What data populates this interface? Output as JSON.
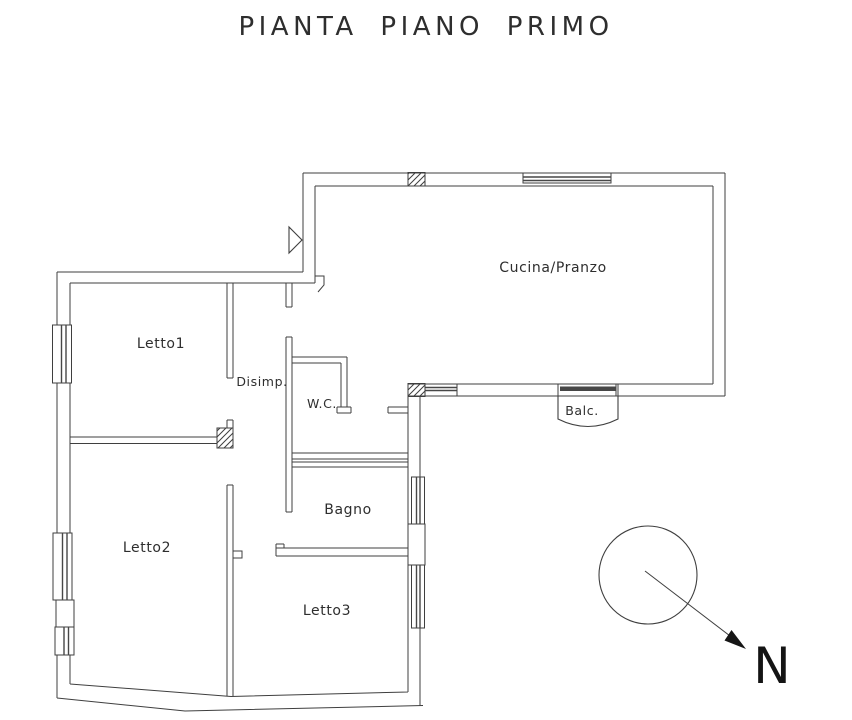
{
  "title": "PIANTA PIANO PRIMO",
  "labels": {
    "cucina": "Cucina/Pranzo",
    "letto1": "Letto1",
    "disimp": "Disimp.",
    "wc": "W.C.",
    "bagno": "Bagno",
    "letto2": "Letto2",
    "letto3": "Letto3",
    "balc": "Balc.",
    "north": "N"
  },
  "colors": {
    "wall": "#3f3f3f",
    "glazing": "#474747",
    "text": "#2e2e2e",
    "background": "#ffffff"
  }
}
